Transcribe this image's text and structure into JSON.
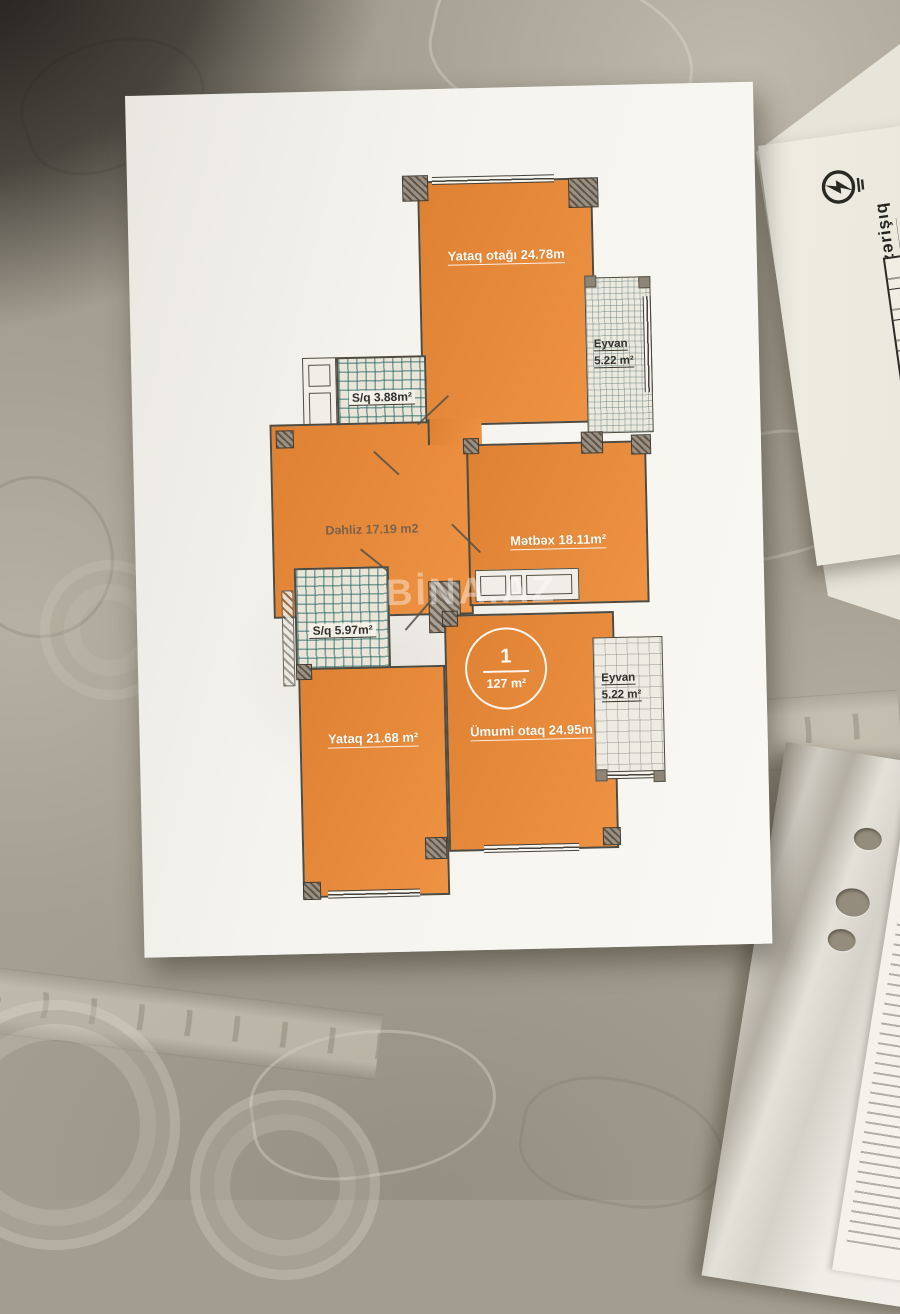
{
  "floor_plan": {
    "watermark": "BİNA.AZ",
    "unit_badge": {
      "number": "1",
      "area": "127 m²"
    },
    "rooms": {
      "bedroom_top": {
        "label": "Yataq otağı 24.78m"
      },
      "balcony_top": {
        "label": "Eyvan",
        "area": "5.22 m²"
      },
      "bath_top": {
        "label": "S/q 3.88m²"
      },
      "hall": {
        "label": "Dəhliz 17.19 m2"
      },
      "kitchen": {
        "label": "Mətbəx 18.11m²"
      },
      "bath_bottom": {
        "label": "S/q 5.97m²"
      },
      "balcony_bottom": {
        "label": "Eyvan",
        "area": "5.22 m²"
      },
      "bedroom_bottom": {
        "label": "Yataq 21.68 m²"
      },
      "living_room": {
        "label": "Ümumi otaq 24.95m"
      }
    }
  },
  "side_document": {
    "brand": "azərişıq"
  },
  "colors": {
    "plan_orange": "#e8893c",
    "tile_teal": "#2a6f6f",
    "paper": "#f5f3ee",
    "tablecloth": "#a59f92",
    "wall_line": "#4f4b40"
  }
}
